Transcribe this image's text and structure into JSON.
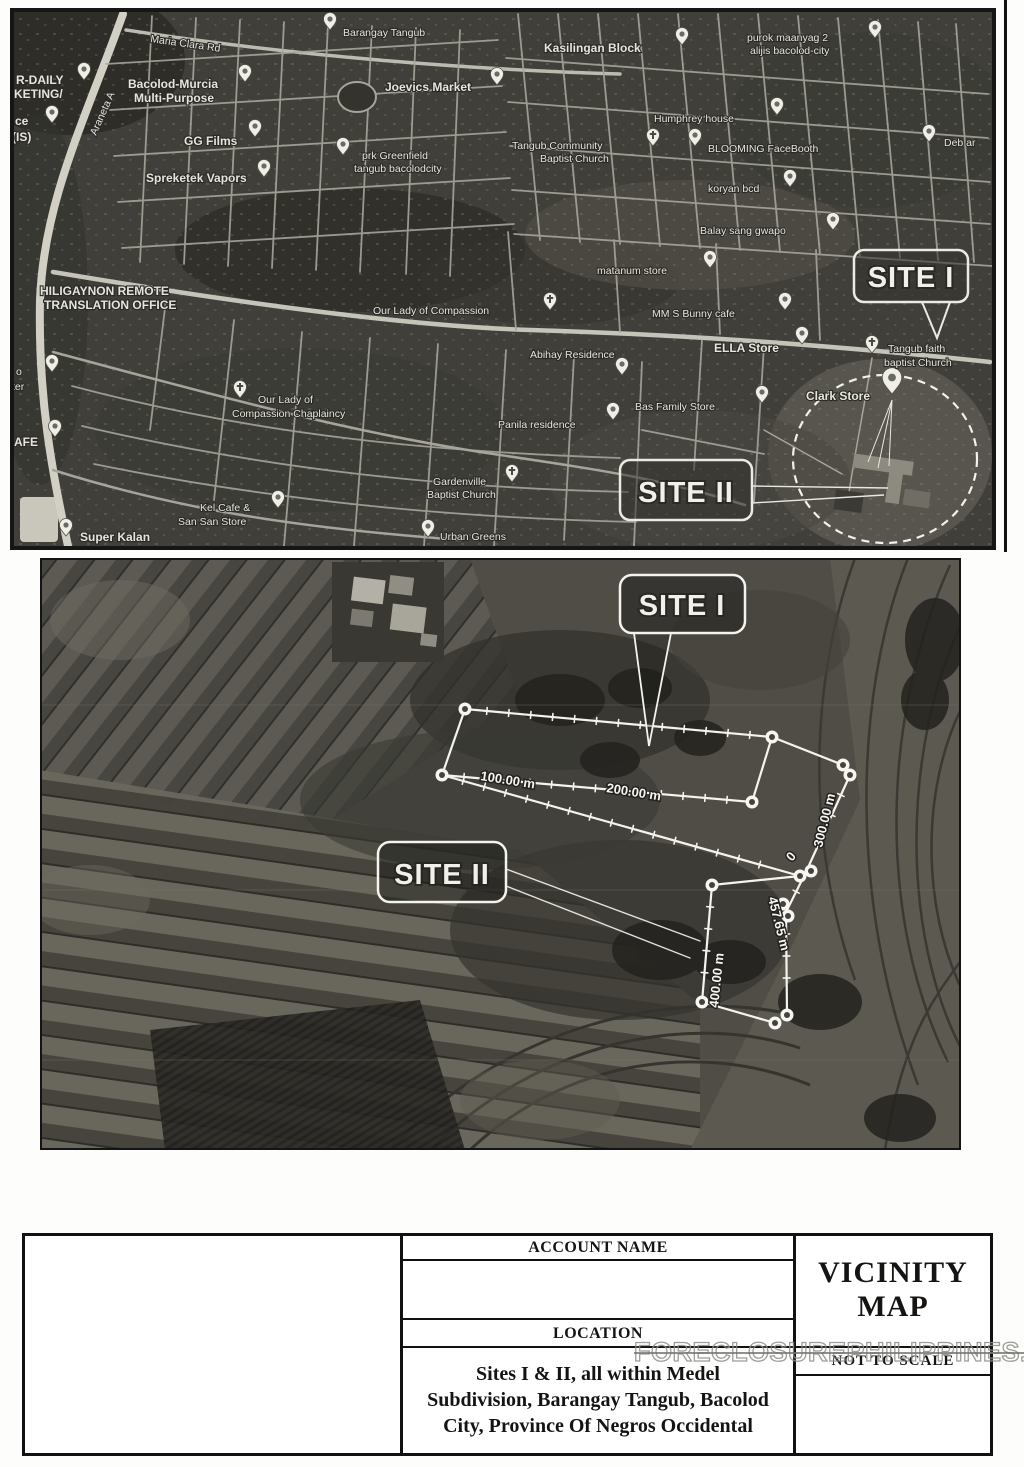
{
  "top_map": {
    "site1_label": "SITE I",
    "site2_label": "SITE II",
    "labels": [
      {
        "text": "Araneta A",
        "x": 96,
        "y": 136,
        "rot": -66
      },
      {
        "text": "Maria Clara Rd",
        "x": 150,
        "y": 42,
        "rot": 8
      },
      {
        "text": "Barangay Tangub",
        "x": 343,
        "y": 36
      },
      {
        "text": "R-DAILY",
        "x": 16,
        "y": 84,
        "big": true
      },
      {
        "text": "KETING/",
        "x": 14,
        "y": 98,
        "big": true
      },
      {
        "text": "ce",
        "x": 15,
        "y": 125,
        "big": true
      },
      {
        "text": "(IS)",
        "x": 12,
        "y": 141,
        "big": true
      },
      {
        "text": "Bacolod-Murcia",
        "x": 128,
        "y": 88,
        "big": true
      },
      {
        "text": "Multi-Purpose",
        "x": 134,
        "y": 102,
        "big": true
      },
      {
        "text": "Joevics Market",
        "x": 385,
        "y": 91,
        "big": true
      },
      {
        "text": "GG Films",
        "x": 184,
        "y": 145,
        "big": true
      },
      {
        "text": "prk Greenfield",
        "x": 362,
        "y": 159
      },
      {
        "text": "tangub bacolodcity",
        "x": 354,
        "y": 172
      },
      {
        "text": "Spreketek Vapors",
        "x": 146,
        "y": 182,
        "big": true
      },
      {
        "text": "Kasilingan Block",
        "x": 544,
        "y": 52,
        "big": true
      },
      {
        "text": "purok maanyag 2",
        "x": 747,
        "y": 41
      },
      {
        "text": "alijis bacolod-city",
        "x": 750,
        "y": 54
      },
      {
        "text": "Humphrey house",
        "x": 654,
        "y": 122
      },
      {
        "text": "Tangub Community",
        "x": 512,
        "y": 149
      },
      {
        "text": "Baptist Church",
        "x": 540,
        "y": 162
      },
      {
        "text": "BLOOMING FaceBooth",
        "x": 708,
        "y": 152
      },
      {
        "text": "koryan bcd",
        "x": 708,
        "y": 192
      },
      {
        "text": "Balay sang gwapo",
        "x": 700,
        "y": 234
      },
      {
        "text": "Deb ar",
        "x": 944,
        "y": 146
      },
      {
        "text": "matanum store",
        "x": 597,
        "y": 274
      },
      {
        "text": "HILIGAYNON REMOTE",
        "x": 40,
        "y": 295,
        "big": true
      },
      {
        "text": "TRANSLATION OFFICE",
        "x": 44,
        "y": 309,
        "big": true
      },
      {
        "text": "Our Lady of Compassion",
        "x": 373,
        "y": 314
      },
      {
        "text": "MM S Bunny cafe",
        "x": 652,
        "y": 317
      },
      {
        "text": "ELLA Store",
        "x": 714,
        "y": 352,
        "big": true
      },
      {
        "text": "Tangub faith",
        "x": 888,
        "y": 352
      },
      {
        "text": "baptist Church",
        "x": 884,
        "y": 366
      },
      {
        "text": "Abihay Residence",
        "x": 530,
        "y": 358
      },
      {
        "text": "Clark Store",
        "x": 806,
        "y": 400,
        "big": true
      },
      {
        "text": "Bas Family Store",
        "x": 635,
        "y": 410
      },
      {
        "text": "Our Lady of",
        "x": 258,
        "y": 403
      },
      {
        "text": "Compassion Chaplaincy",
        "x": 232,
        "y": 417
      },
      {
        "text": "Panila residence",
        "x": 498,
        "y": 428
      },
      {
        "text": "o",
        "x": 16,
        "y": 375
      },
      {
        "text": "ter",
        "x": 12,
        "y": 390
      },
      {
        "text": "AFE",
        "x": 14,
        "y": 446,
        "big": true
      },
      {
        "text": "Gardenville",
        "x": 433,
        "y": 485
      },
      {
        "text": "Baptist Church",
        "x": 427,
        "y": 498
      },
      {
        "text": "Kel Cafe &",
        "x": 200,
        "y": 511
      },
      {
        "text": "San San Store",
        "x": 178,
        "y": 525
      },
      {
        "text": "Super Kalan",
        "x": 80,
        "y": 541,
        "big": true
      },
      {
        "text": "Urban Greens",
        "x": 440,
        "y": 540
      }
    ],
    "pins": [
      {
        "x": 84,
        "y": 80
      },
      {
        "x": 52,
        "y": 123
      },
      {
        "x": 245,
        "y": 82
      },
      {
        "x": 497,
        "y": 85
      },
      {
        "x": 255,
        "y": 137
      },
      {
        "x": 343,
        "y": 155
      },
      {
        "x": 264,
        "y": 177
      },
      {
        "x": 330,
        "y": 30
      },
      {
        "x": 682,
        "y": 45
      },
      {
        "x": 875,
        "y": 38
      },
      {
        "x": 777,
        "y": 115
      },
      {
        "x": 653,
        "y": 146,
        "kind": "church"
      },
      {
        "x": 695,
        "y": 146
      },
      {
        "x": 790,
        "y": 187
      },
      {
        "x": 833,
        "y": 230
      },
      {
        "x": 929,
        "y": 142
      },
      {
        "x": 710,
        "y": 268
      },
      {
        "x": 550,
        "y": 310,
        "kind": "church"
      },
      {
        "x": 785,
        "y": 310
      },
      {
        "x": 802,
        "y": 344
      },
      {
        "x": 872,
        "y": 353,
        "kind": "church"
      },
      {
        "x": 622,
        "y": 375
      },
      {
        "x": 892,
        "y": 394,
        "s": 1.5
      },
      {
        "x": 762,
        "y": 403
      },
      {
        "x": 240,
        "y": 398,
        "kind": "church"
      },
      {
        "x": 613,
        "y": 420
      },
      {
        "x": 52,
        "y": 372
      },
      {
        "x": 55,
        "y": 437
      },
      {
        "x": 512,
        "y": 482,
        "kind": "church"
      },
      {
        "x": 278,
        "y": 508
      },
      {
        "x": 66,
        "y": 536
      },
      {
        "x": 428,
        "y": 537
      }
    ]
  },
  "bottom_map": {
    "site1_label": "SITE I",
    "site2_label": "SITE II",
    "measurements": [
      {
        "text": "100.00 m",
        "x": 480,
        "y": 780,
        "rot": 9
      },
      {
        "text": "200.00 m",
        "x": 606,
        "y": 792,
        "rot": 9
      },
      {
        "text": "300.00 m",
        "x": 822,
        "y": 848,
        "rot": -76
      },
      {
        "text": "0",
        "x": 792,
        "y": 862,
        "rot": -50
      },
      {
        "text": "457.65 m",
        "x": 768,
        "y": 898,
        "rot": 76
      },
      {
        "text": "400.00 m",
        "x": 718,
        "y": 1008,
        "rot": -84
      }
    ]
  },
  "table": {
    "account_name_label": "ACCOUNT NAME",
    "account_name_value": "",
    "location_label": "LOCATION",
    "location_lines": [
      "Sites I & II, all within Medel",
      "Subdivision, Barangay Tangub, Bacolod",
      "City, Province Of Negros Occidental"
    ],
    "title_lines": [
      "VICINITY",
      "MAP"
    ],
    "scale_note": "NOT TO SCALE"
  },
  "watermark": "FORECLOSUREPHILIPPINES.COM"
}
